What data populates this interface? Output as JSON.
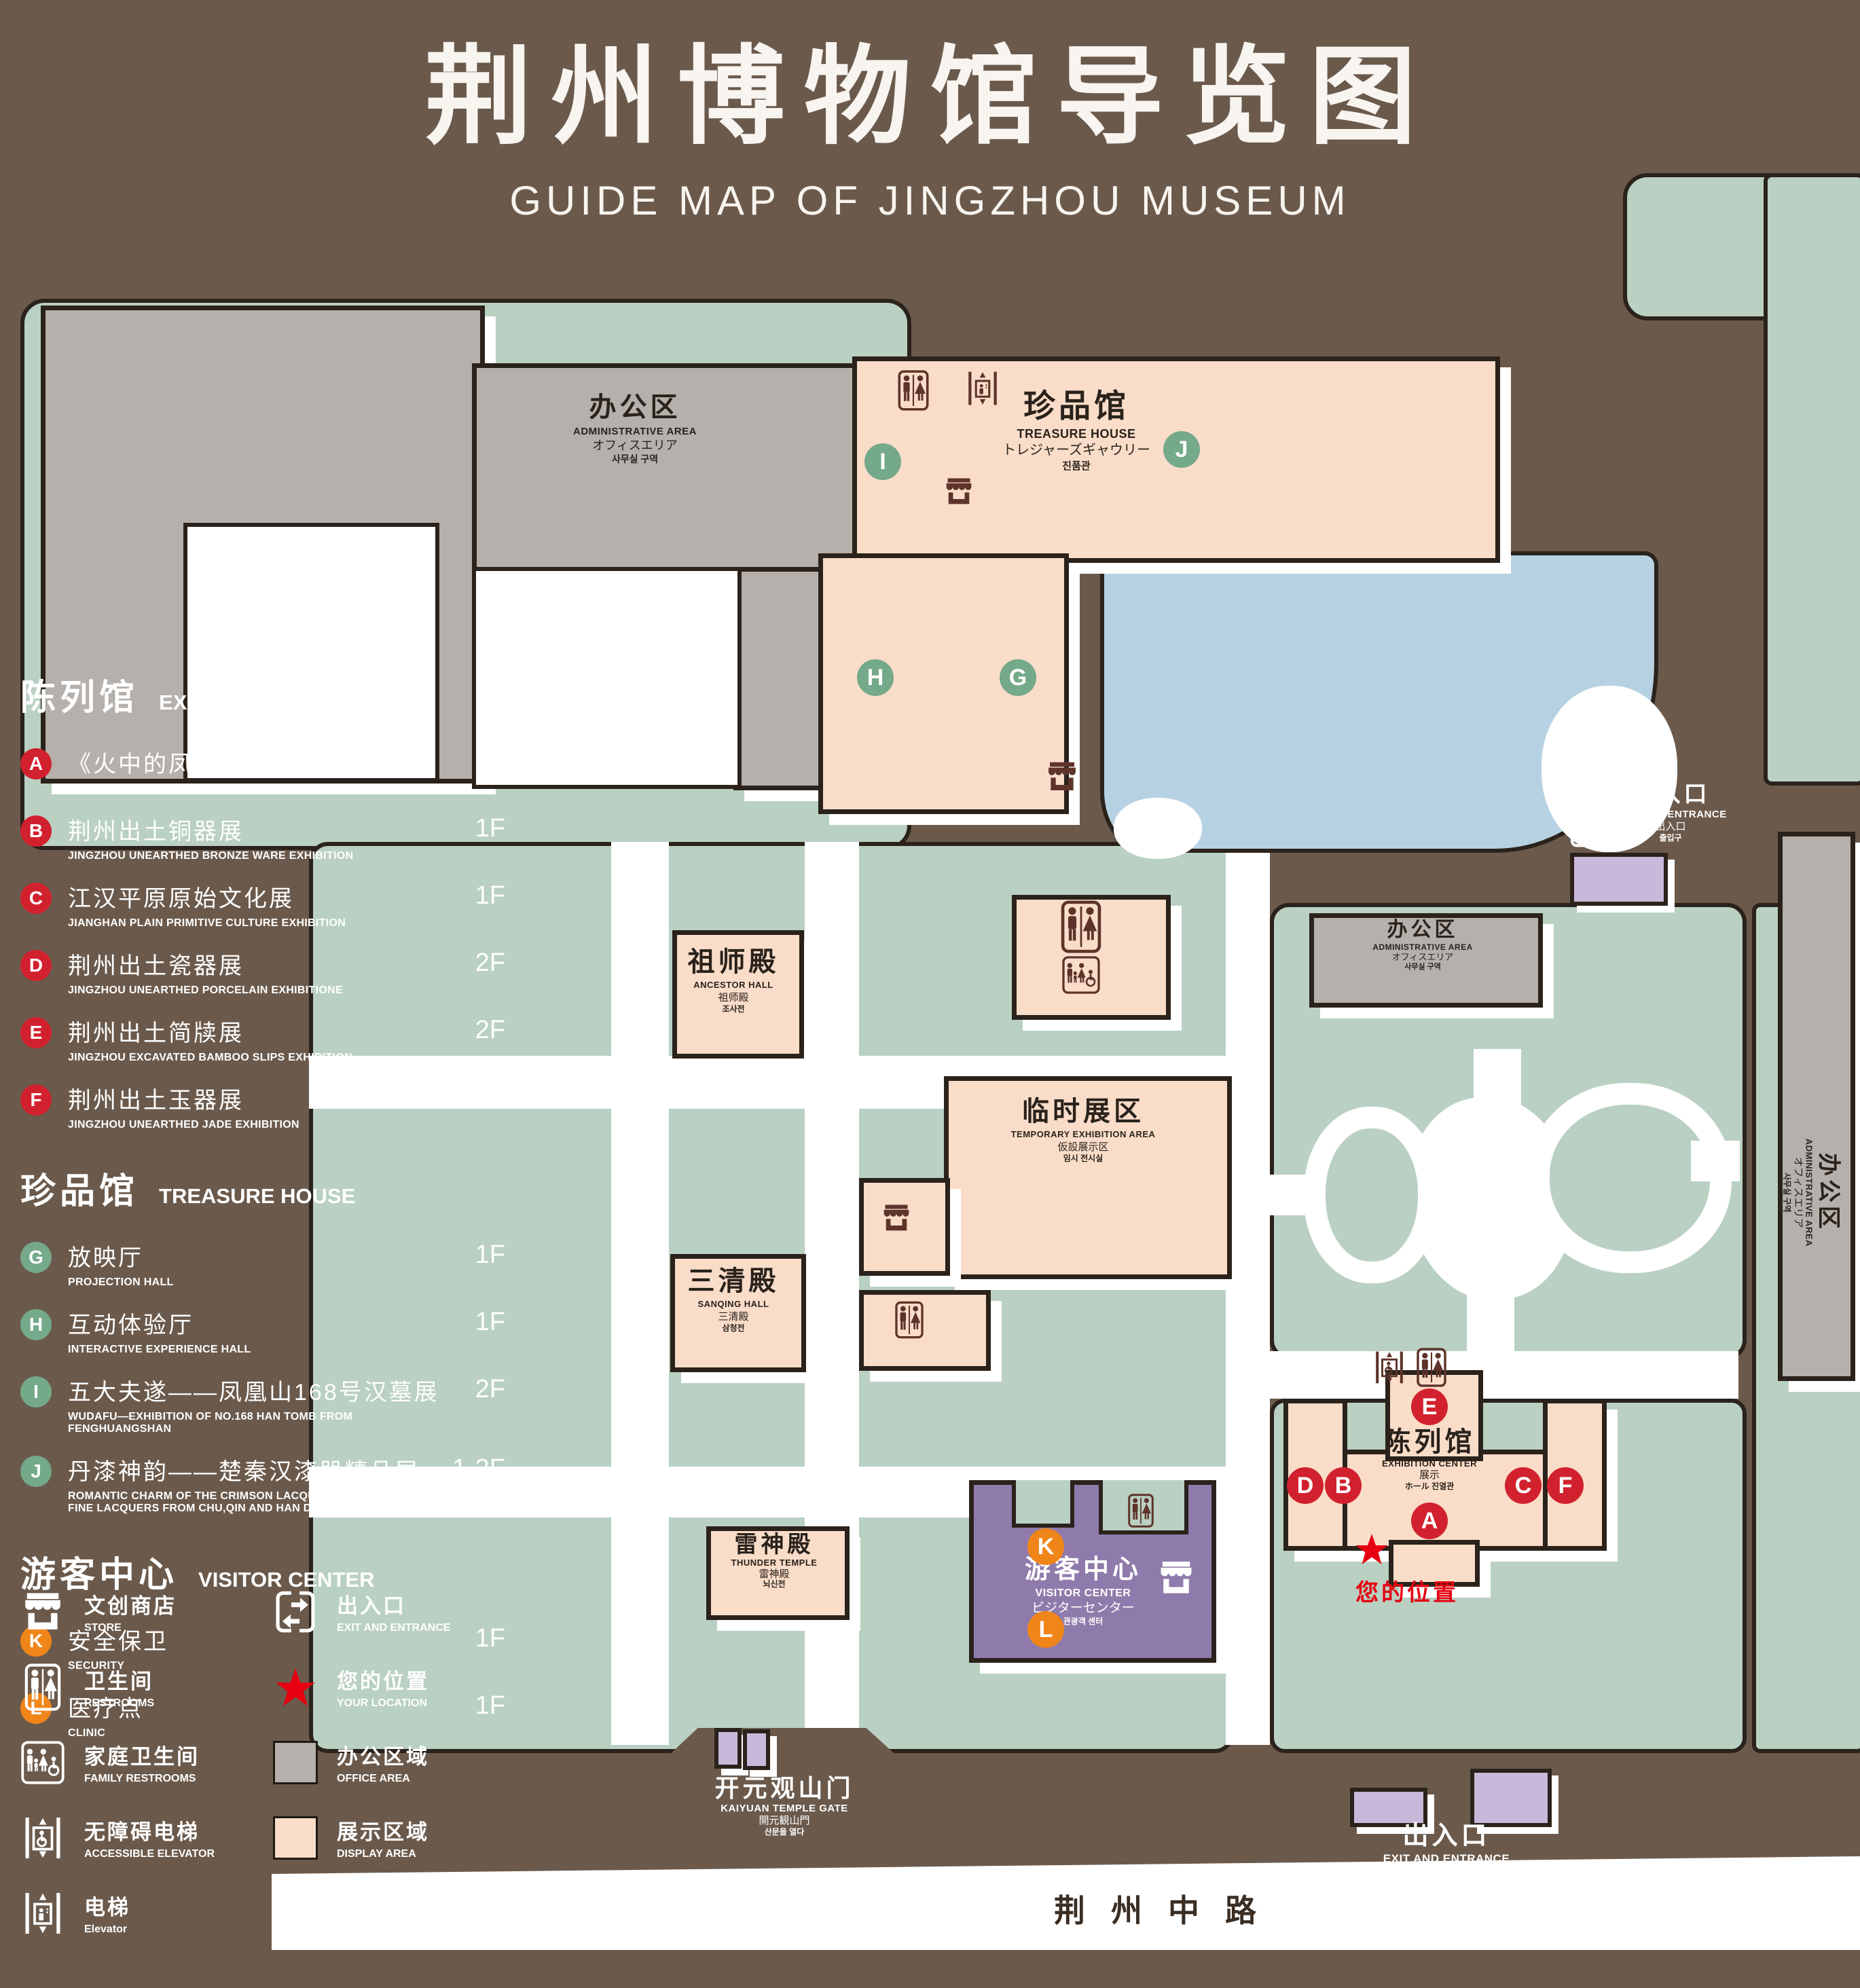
{
  "title": {
    "cn": "荆州博物馆导览图",
    "en": "GUIDE MAP OF JINGZHOU MUSEUM"
  },
  "colors": {
    "background": "#6B5A4C",
    "mint_green": "#B9D0C2",
    "display_pink": "#F9DDC9",
    "office_gray": "#B5B0AC",
    "pond_blue": "#B6D2E2",
    "visitor_purple": "#8F7BAB",
    "gate_purple": "#C9B8D9",
    "icon_maroon": "#5E332A",
    "marker_red": "#D2212E",
    "marker_green": "#74A98A",
    "marker_orange": "#F08519",
    "location_red": "#E60012"
  },
  "legend": {
    "sections": [
      {
        "cn": "陈列馆",
        "en": "EXHIBITION CENTER",
        "items": [
          {
            "letter": "A",
            "cn": "《火中的凤凰》壁画",
            "en": "THE PHOENIX IN FIRE \"MURAL PAINTING",
            "floor": "1F"
          },
          {
            "letter": "B",
            "cn": "荆州出土铜器展",
            "en": "JINGZHOU UNEARTHED BRONZE WARE EXHIBITION",
            "floor": "1F"
          },
          {
            "letter": "C",
            "cn": "江汉平原原始文化展",
            "en": "JIANGHAN PLAIN PRIMITIVE CULTURE EXHIBITION",
            "floor": "1F"
          },
          {
            "letter": "D",
            "cn": "荆州出土瓷器展",
            "en": "JINGZHOU UNEARTHED PORCELAIN EXHIBITIONE",
            "floor": "2F"
          },
          {
            "letter": "E",
            "cn": "荆州出土简牍展",
            "en": "JINGZHOU EXCAVATED BAMBOO SLIPS EXHIBITION",
            "floor": "2F"
          },
          {
            "letter": "F",
            "cn": "荆州出土玉器展",
            "en": "JINGZHOU UNEARTHED JADE EXHIBITION",
            "floor": "2F"
          }
        ]
      },
      {
        "cn": "珍品馆",
        "en": "TREASURE HOUSE",
        "items": [
          {
            "letter": "G",
            "cn": "放映厅",
            "en": "PROJECTION HALL",
            "floor": "1F"
          },
          {
            "letter": "H",
            "cn": "互动体验厅",
            "en": "INTERACTIVE EXPERIENCE HALL",
            "floor": "1F"
          },
          {
            "letter": "I",
            "cn": "五大夫遂——凤凰山168号汉墓展",
            "en": "WUDAFU—EXHIBITION OF NO.168 HAN TOMB FROM FENGHUANGSHAN",
            "floor": "2F"
          },
          {
            "letter": "J",
            "cn": "丹漆神韵——楚秦汉漆器精品展",
            "en": "ROMANTIC CHARM OF THE CRIMSON LACQUERS—EXHIBITIONS OF FINE LACQUERS FROM CHU,QIN AND HAN DYNASTIES",
            "floor": "1-2F"
          }
        ]
      },
      {
        "cn": "游客中心",
        "en": "VISITOR CENTER",
        "items": [
          {
            "letter": "K",
            "cn": "安全保卫",
            "en": "SECURITY",
            "floor": "1F"
          },
          {
            "letter": "L",
            "cn": "医疗点",
            "en": "CLINIC",
            "floor": "1F"
          }
        ]
      }
    ],
    "symbols": [
      {
        "icon": "store-icon",
        "cn": "文创商店",
        "en": "STORE"
      },
      {
        "icon": "exit-icon",
        "cn": "出入口",
        "en": "EXIT AND ENTRANCE"
      },
      {
        "icon": "restroom-icon",
        "cn": "卫生间",
        "en": "RESTROOMS"
      },
      {
        "icon": "location-star-icon",
        "cn": "您的位置",
        "en": "YOUR LOCATION"
      },
      {
        "icon": "family-restroom-icon",
        "cn": "家庭卫生间",
        "en": "FAMILY RESTROOMS"
      },
      {
        "icon": "office-area-swatch",
        "cn": "办公区域",
        "en": "OFFICE AREA"
      },
      {
        "icon": "accessible-elevator-icon",
        "cn": "无障碍电梯",
        "en": "ACCESSIBLE ELEVATOR"
      },
      {
        "icon": "display-area-swatch",
        "cn": "展示区域",
        "en": "DISPLAY AREA"
      },
      {
        "icon": "elevator-icon",
        "cn": "电梯",
        "en": "Elevator"
      }
    ]
  },
  "map": {
    "admin": {
      "cn": "办公区",
      "en": "ADMINISTRATIVE AREA",
      "jp": "オフィスエリア",
      "kr": "사무실 구역"
    },
    "treasure": {
      "cn": "珍品馆",
      "en": "TREASURE HOUSE",
      "jp": "トレジャーズギャウリー",
      "kr": "진품관"
    },
    "ancestor": {
      "cn": "祖师殿",
      "en": "ANCESTOR HALL",
      "jp": "祖师殿",
      "kr": "조사전"
    },
    "temporary": {
      "cn": "临时展区",
      "en": "TEMPORARY EXHIBITION AREA",
      "jp": "仮設展示区",
      "kr": "임시 전시실"
    },
    "sanqing": {
      "cn": "三清殿",
      "en": "SANQING HALL",
      "jp": "三清殿",
      "kr": "삼청전"
    },
    "thunder": {
      "cn": "雷神殿",
      "en": "THUNDER TEMPLE",
      "jp": "雷神殿",
      "kr": "뇌신전"
    },
    "visitor": {
      "cn": "游客中心",
      "en": "VISITOR CENTER",
      "jp": "ビジターセンター",
      "kr": "관광객 센터"
    },
    "exhibition": {
      "cn": "陈列馆",
      "en": "EXHIBITION CENTER",
      "jp": "展示",
      "kr": "ホール 진열관"
    },
    "exit": {
      "cn": "出入口",
      "en": "EXIT AND ENTRANCE",
      "jp": "出入口",
      "kr": "출입구"
    },
    "gate": {
      "cn": "开元观山门",
      "en": "KAIYUAN TEMPLE GATE",
      "jp": "開元観山門",
      "kr": "산문을 열다"
    },
    "your_location": "您的位置",
    "road": "荆州中路",
    "markers": {
      "a": "A",
      "b": "B",
      "c": "C",
      "d": "D",
      "e": "E",
      "f": "F",
      "g": "G",
      "h": "H",
      "i": "I",
      "j": "J",
      "k": "K",
      "l": "L"
    }
  }
}
